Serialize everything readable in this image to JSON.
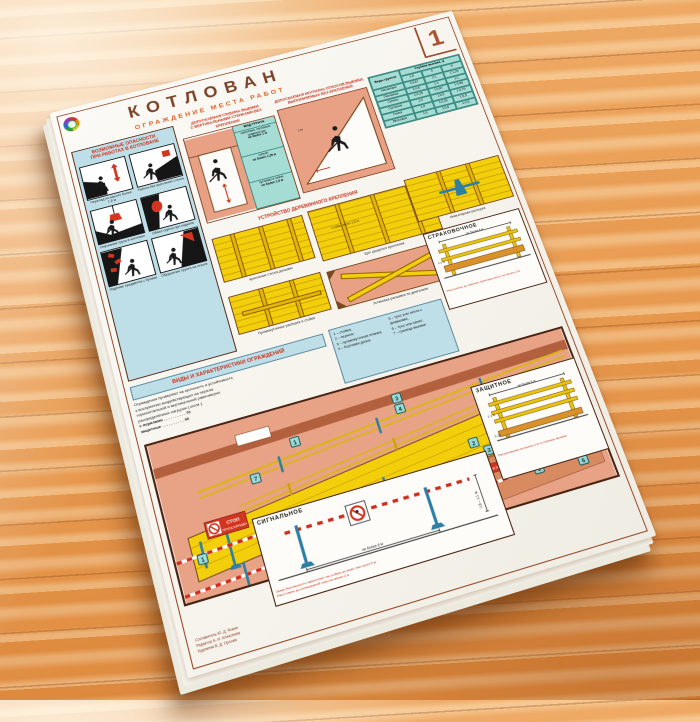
{
  "poster": {
    "number": "1",
    "title": "КОТЛОВАН",
    "subtitle": "ОГРАЖДЕНИЕ МЕСТА РАБОТ"
  },
  "hazards": {
    "title_line1": "ВОЗМОЖНЫЕ ОПАСНОСТИ",
    "title_line2": "ПРИ РАБОТАХ В КОТЛОВАНЕ",
    "items": [
      {
        "caption": "Перепад по высоте более 1,8 м"
      },
      {
        "caption": "Работа без крепления стенок"
      },
      {
        "caption": "Опускание груза в котлован"
      },
      {
        "caption": "Обвал грунта при подкопе"
      },
      {
        "caption": "Падение предметов с бровки"
      },
      {
        "caption": "Обрушение грунта на откосе"
      }
    ]
  },
  "depth": {
    "title_line1": "ДОПУСКАЕМАЯ ГЛУБИНА ВЫЕМКИ",
    "title_line2": "С ВЕРТИКАЛЬНЫМИ СТЕНКАМИ БЕЗ КРЕПЛЕНИЯ",
    "table_header": "ВИД ГРУНТА",
    "rows": [
      {
        "soil": "насыпные, песчаные, гравелистые",
        "depth": "не более 1 м"
      },
      {
        "soil": "супеси",
        "depth": "не более 1,25 м"
      },
      {
        "soil": "суглинки и глины",
        "depth": "не более 1,5 м"
      }
    ]
  },
  "slope": {
    "title_line1": "ДОПУСКАЕМАЯ КРУТИЗНА ОТКОСОВ ВЫЕМКИ,",
    "title_line2": "ВЫПОЛНЯЕМЫХ БЕЗ КРЕПЛЕНИЙ",
    "table": {
      "col_soil": "Виды грунтов",
      "col_depth": "Глубина выемки, м",
      "depths": [
        "1,5",
        "3",
        "5"
      ],
      "rows": [
        {
          "soil": "Насыпные",
          "v": [
            "1:0,67",
            "1:1",
            "1:1,25"
          ]
        },
        {
          "soil": "Песчаные",
          "v": [
            "1:0,5",
            "1:1",
            "1:1"
          ]
        },
        {
          "soil": "Супесь",
          "v": [
            "1:0,25",
            "1:0,67",
            "1:0,85"
          ]
        },
        {
          "soil": "Суглинок",
          "v": [
            "1:0",
            "1:0,5",
            "1:0,75"
          ]
        },
        {
          "soil": "Глина",
          "v": [
            "1:0",
            "1:0,25",
            "1:0,5"
          ]
        },
        {
          "soil": "Лёссовые",
          "v": [
            "1:0",
            "1:0,5",
            "1:0,5"
          ]
        }
      ]
    }
  },
  "shoring": {
    "title": "УСТРОЙСТВО ДЕРЕВЯННОГО КРЕПЛЕНИЯ",
    "captions": {
      "boards": "Крепление стенок досками",
      "shield": "Щит дощатого крепления",
      "strut": "Инвентарная распорка",
      "interposts": "Промежуточные распорки и стойки",
      "diagonal": "Установка расшивок по диагонали"
    },
    "shield_note": "стойки через 1,5 м"
  },
  "fence_info": {
    "header": "ВИДЫ И ХАРАКТЕРИСТИКИ ОГРАЖДЕНИЙ",
    "note_lines": [
      "Ограждения проверяют на прочность и устойчивость",
      "к восприятию воздействующих на перила",
      "горизонтальной и вертикальной равномерно",
      "распределённых нагрузок ( кгс/м ):",
      "с перилами . . . . . . . . . . 70",
      "защитные . . . . . . . . . . 40"
    ],
    "legend": [
      "1 – стойка;",
      "2 – перила;",
      "3 – промежуточная планка;",
      "4 – бортовая доска;",
      "5 – трос или лента с флажками;",
      "6 – трос или канат;",
      "7 – граница выемки"
    ]
  },
  "panel_strakh": {
    "title": "СТРАХОВОЧНОЕ",
    "dim_span": "не более 6 м",
    "dim_height": "1,1 м",
    "caption": "Расстояние до границы перепада высот не менее 2 м"
  },
  "panel_zashchit": {
    "title": "ЗАЩИТНОЕ",
    "dim_span": "не более 6 м",
    "dim_height": "1,1 м",
    "dim_board": "0,15",
    "caption": "Расположение не менее 2 м от границы выемки"
  },
  "panel_signal": {
    "title": "СИГНАЛЬНОЕ",
    "dim_span": "не более 6 м",
    "dim_height": "0,8 – 1,1 м",
    "note": "Знаки безопасности закрепляют на стойках не реже чем через 6 м",
    "caption": "Расстояние до ограждаемой зоны не менее 2 м"
  },
  "scene": {
    "sign_stop_word": "СТОП",
    "sign_stop_text": "ПРОХОД ЗАПРЕЩЁН",
    "sign_no_entry_text": "ПРОХОД ЗАПРЕЩЁН",
    "callouts": [
      "1",
      "2",
      "3",
      "4",
      "5",
      "6",
      "7"
    ]
  },
  "credits": {
    "line1": "Составитель Ю. Д. Фокин",
    "line2": "Редактор А. И. Алексеева",
    "line3": "Художник В. Д. Орлова"
  },
  "colors": {
    "accent_red": "#c8341f",
    "panel_blue": "#bfdfe8",
    "table_teal": "#a5dcd4",
    "wood_yellow": "#f3cf0b",
    "frame_brown": "#9a4f2e",
    "scene_pink": "#e8a285"
  }
}
